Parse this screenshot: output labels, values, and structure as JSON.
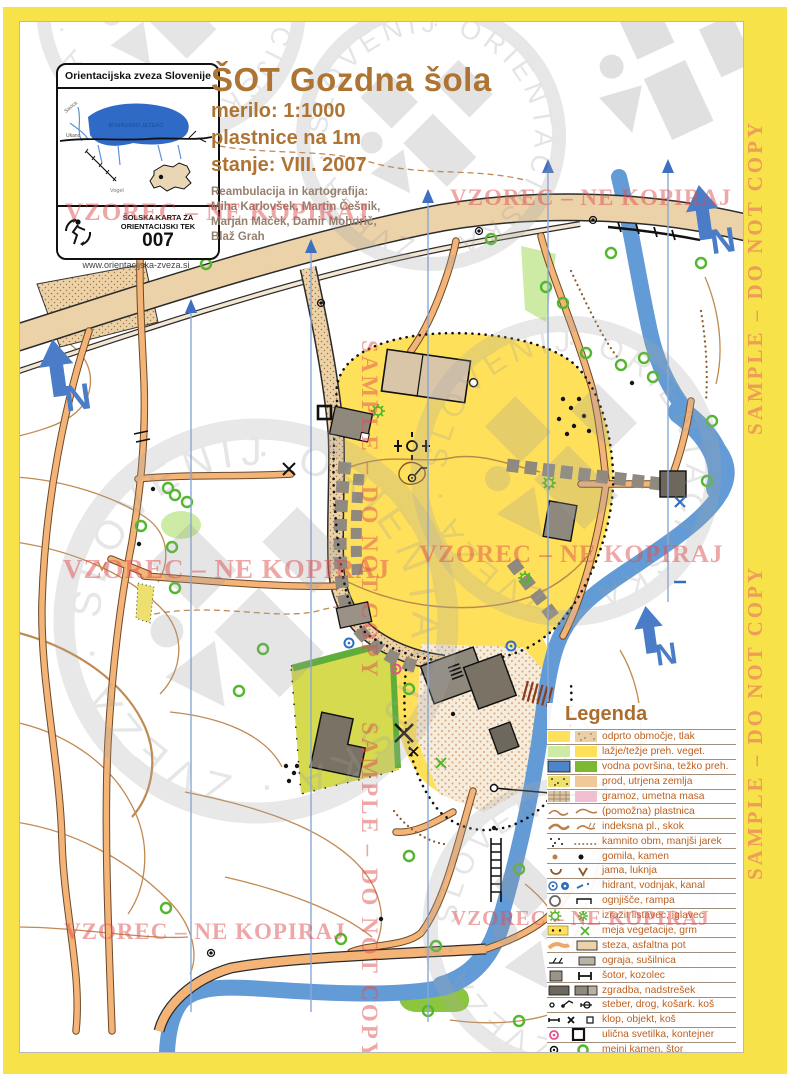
{
  "logo_box": {
    "header": "Orientacijska zveza Slovenije",
    "lake_label": "BOHINJSKO JEZERO",
    "label_savica": "Savica",
    "label_ukanc": "Ukanc",
    "label_vogel": "Vogel",
    "school_card_line1": "ŠOLSKA KARTA ZA",
    "school_card_line2": "ORIENTACIJSKI TEK",
    "number": "007",
    "website": "www.orientacijska-zveza.si"
  },
  "title": {
    "main": "ŠOT Gozdna šola",
    "scale": "merilo: 1:1000",
    "contours": "plastnice na 1m",
    "state": "stanje: VIII. 2007",
    "credits_heading": "Reambulacija in kartografija:",
    "credits_line1": "Miha Karlovšek, Martin Češnik,",
    "credits_line2": "Marjan Maček, Damir Mohorič,",
    "credits_line3": "Blaž Grah"
  },
  "watermarks": {
    "vzorec": "VZOREC – NE KOPIRAJ",
    "sample": "SAMPLE – DO NOT COPY",
    "ring": "· ORIENTACIJSKA · ZVEZA · SLOVENIJE · ORIENTACIJSKA · ZVEZA ·"
  },
  "legend": {
    "heading": "Legenda",
    "items": [
      {
        "label": "odprto območje, tlak"
      },
      {
        "label": "lažje/težje preh. veget."
      },
      {
        "label": "vodna površina, težko preh."
      },
      {
        "label": "prod, utrjena zemlja"
      },
      {
        "label": "gramoz, umetna masa"
      },
      {
        "label": "(pomožna) plastnica"
      },
      {
        "label": "indeksna pl., skok"
      },
      {
        "label": "kamnito obm, manjši jarek"
      },
      {
        "label": "gomila, kamen"
      },
      {
        "label": "jama, luknja"
      },
      {
        "label": "hidrant, vodnjak, kanal"
      },
      {
        "label": "ognjišče, rampa"
      },
      {
        "label": "izrazit listavec, iglavec"
      },
      {
        "label": "meja vegetacije, grm"
      },
      {
        "label": "steza, asfaltna pot"
      },
      {
        "label": "ograja, sušilnica"
      },
      {
        "label": "šotor, kozolec"
      },
      {
        "label": "zgradba, nadstrešek"
      },
      {
        "label": "steber, drog, košark. koš"
      },
      {
        "label": "klop, objekt, koš"
      },
      {
        "label": "ulična svetilka, kontejner"
      },
      {
        "label": "mejni kamen, štor"
      }
    ]
  },
  "colors": {
    "frame_yellow": "#F7E24A",
    "open_yellow": "#FFE05A",
    "river_blue": "#639BD6",
    "road_tan": "#EBD2A9",
    "path_orange": "#F4B478",
    "tree_green": "#53B72E",
    "olive_field": "#D5DA4F",
    "contour_brown": "#C08A52",
    "north_blue": "#4A7CC7",
    "watermark_red": "#DF4D4D"
  }
}
